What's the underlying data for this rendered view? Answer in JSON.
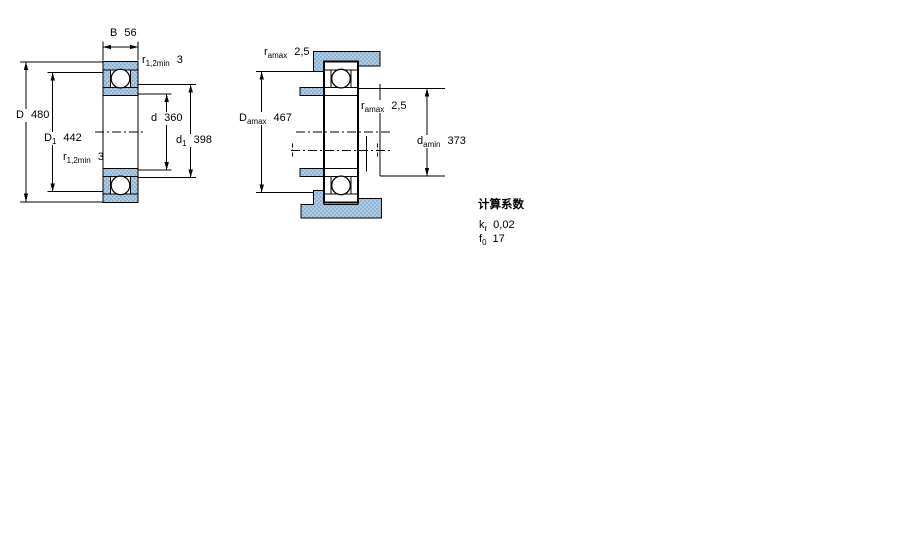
{
  "colors": {
    "hatch_fill": "#aecbdf",
    "hatch_dot": "#84a8c6",
    "line": "#000000",
    "background": "#ffffff"
  },
  "left_drawing": {
    "labels": {
      "width": {
        "symbol": "B",
        "value": "56"
      },
      "fillet_top": {
        "symbol": "r",
        "sub": "1,2min",
        "value": "3"
      },
      "outer_diameter": {
        "symbol": "D",
        "value": "480"
      },
      "recess_diameter": {
        "symbol": "D",
        "sub": "1",
        "value": "442"
      },
      "fillet_bottom": {
        "symbol": "r",
        "sub": "1,2min",
        "value": "3"
      },
      "bore_diameter": {
        "symbol": "d",
        "value": "360"
      },
      "shoulder_diameter": {
        "symbol": "d",
        "sub": "1",
        "value": "398"
      }
    }
  },
  "right_drawing": {
    "labels": {
      "housing_fillet": {
        "symbol": "r",
        "sub": "amax",
        "value": "2,5"
      },
      "housing_abutment": {
        "symbol": "D",
        "sub": "amax",
        "value": "467"
      },
      "shaft_fillet": {
        "symbol": "r",
        "sub": "amax",
        "value": "2,5"
      },
      "shaft_abutment": {
        "symbol": "d",
        "sub": "amin",
        "value": "373"
      }
    }
  },
  "calculation_factors": {
    "heading": "计算系数",
    "rows": [
      {
        "symbol": "k",
        "sub": "r",
        "value": "0,02"
      },
      {
        "symbol": "f",
        "sub": "0",
        "value": "17"
      }
    ]
  }
}
